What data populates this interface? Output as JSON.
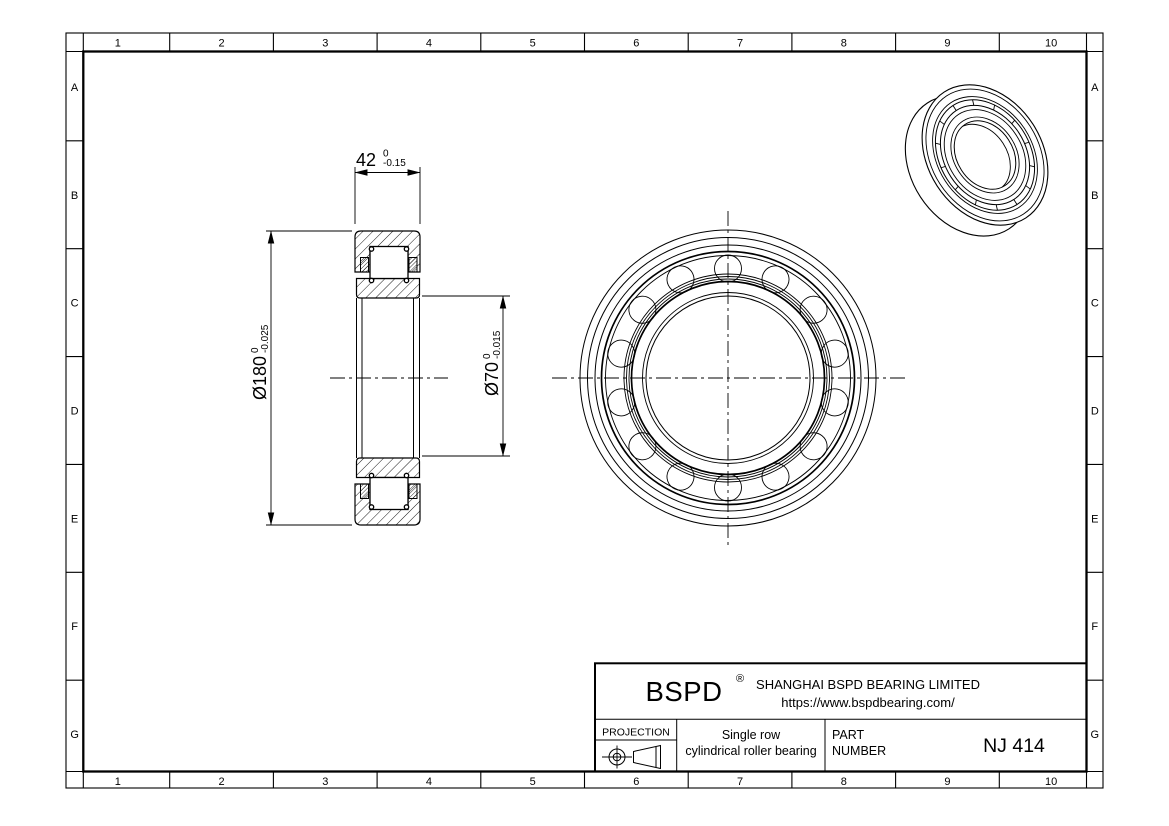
{
  "sheet": {
    "columns": [
      "1",
      "2",
      "3",
      "4",
      "5",
      "6",
      "7",
      "8",
      "9",
      "10"
    ],
    "rows": [
      "A",
      "B",
      "C",
      "D",
      "E",
      "F",
      "G"
    ]
  },
  "dimensions": {
    "width": {
      "value": "42",
      "tol_upper": "0",
      "tol_lower": "-0.15"
    },
    "outer_diameter": {
      "value": "Ø180",
      "tol_upper": "0",
      "tol_lower": "-0.025"
    },
    "bore": {
      "value": "Ø70",
      "tol_upper": "0",
      "tol_lower": "-0.015"
    }
  },
  "title_block": {
    "brand": "BSPD",
    "registered_mark": "®",
    "company": "SHANGHAI BSPD BEARING LIMITED",
    "website": "https://www.bspdbearing.com/",
    "projection_label": "PROJECTION",
    "description_line1": "Single row",
    "description_line2": "cylindrical roller bearing",
    "part_label_line1": "PART",
    "part_label_line2": "NUMBER",
    "part_number": "NJ 414"
  },
  "colors": {
    "ink": "#000000",
    "paper": "#ffffff"
  }
}
